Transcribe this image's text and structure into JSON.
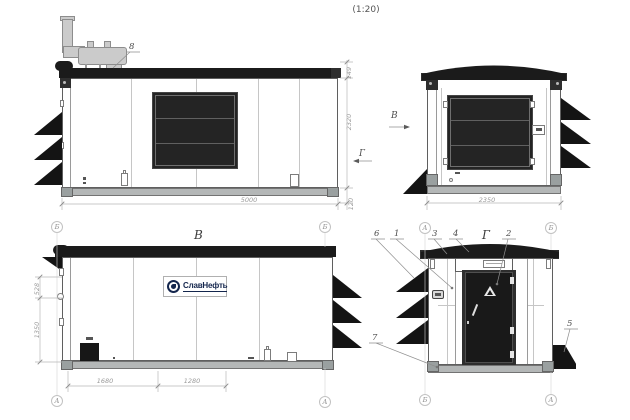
{
  "scale_note": "(1:20)",
  "colors": {
    "dark": "#1b1b1b",
    "skid_gray": "#b4b7b7",
    "exhaust_gray": "#cbcbcb",
    "line_gray": "#8f8f8f",
    "dim_gray": "#9b9b9b"
  },
  "view_side": {
    "callout_exhaust": "8",
    "dim_length": "5000",
    "dim_roof": "149",
    "dim_wall": "2320",
    "dim_skid": "120",
    "section_mark": "Г"
  },
  "view_rear": {
    "view_mark": "В",
    "dim_width": "2350"
  },
  "view_b": {
    "title": "В",
    "logo": "СлавНефть",
    "dim_bottom_1": "1680",
    "dim_bottom_2": "1280",
    "dim_left_upper": "528",
    "dim_left_lower": "1350",
    "axis": {
      "lt": "Б",
      "lb": "А",
      "rt": "Б",
      "rb": "А"
    }
  },
  "view_g": {
    "title": "Г",
    "axis": {
      "lt": "А",
      "lb": "Б",
      "rt": "Б",
      "rb": "А"
    },
    "callouts": {
      "n1": "1",
      "n2": "2",
      "n3": "3",
      "n4": "4",
      "n5": "5",
      "n6": "6",
      "n7": "7"
    }
  }
}
